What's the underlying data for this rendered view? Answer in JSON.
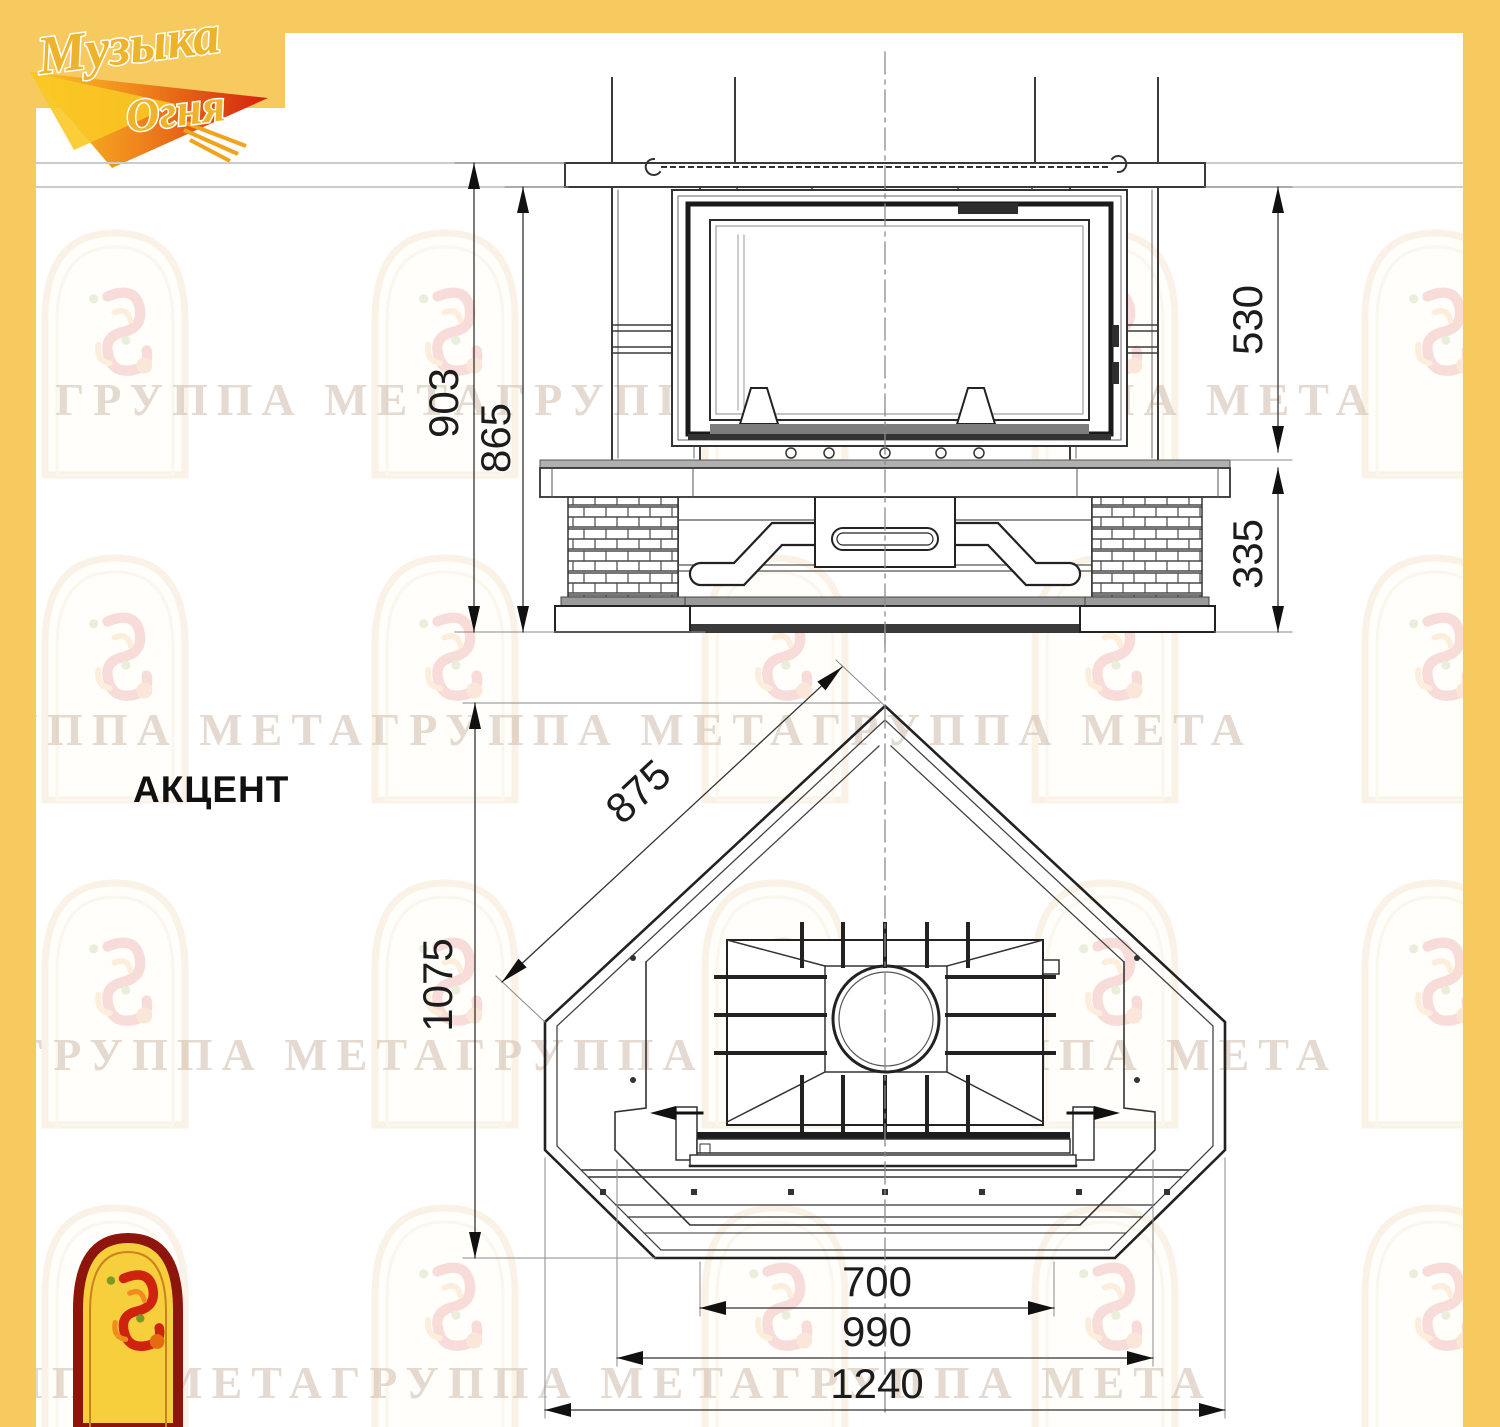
{
  "page": {
    "background": "#ffffff",
    "frame_color": "#f6ca5f"
  },
  "brand_logo": {
    "line1": "Музыка",
    "line2": "Огня"
  },
  "model_title": "АКЦЕНТ",
  "watermark": {
    "text": "ГРУППА МЕТАГРУППА МЕТАГРУППА МЕТА"
  },
  "elevation": {
    "dims": {
      "total_height": "903",
      "mantel_height": "865",
      "firebox_height": "530",
      "base_height": "335"
    }
  },
  "plan": {
    "dims": {
      "side_width": "875",
      "depth": "1075",
      "insert_front_width": "700",
      "inner_width": "990",
      "overall_width": "1240"
    }
  }
}
